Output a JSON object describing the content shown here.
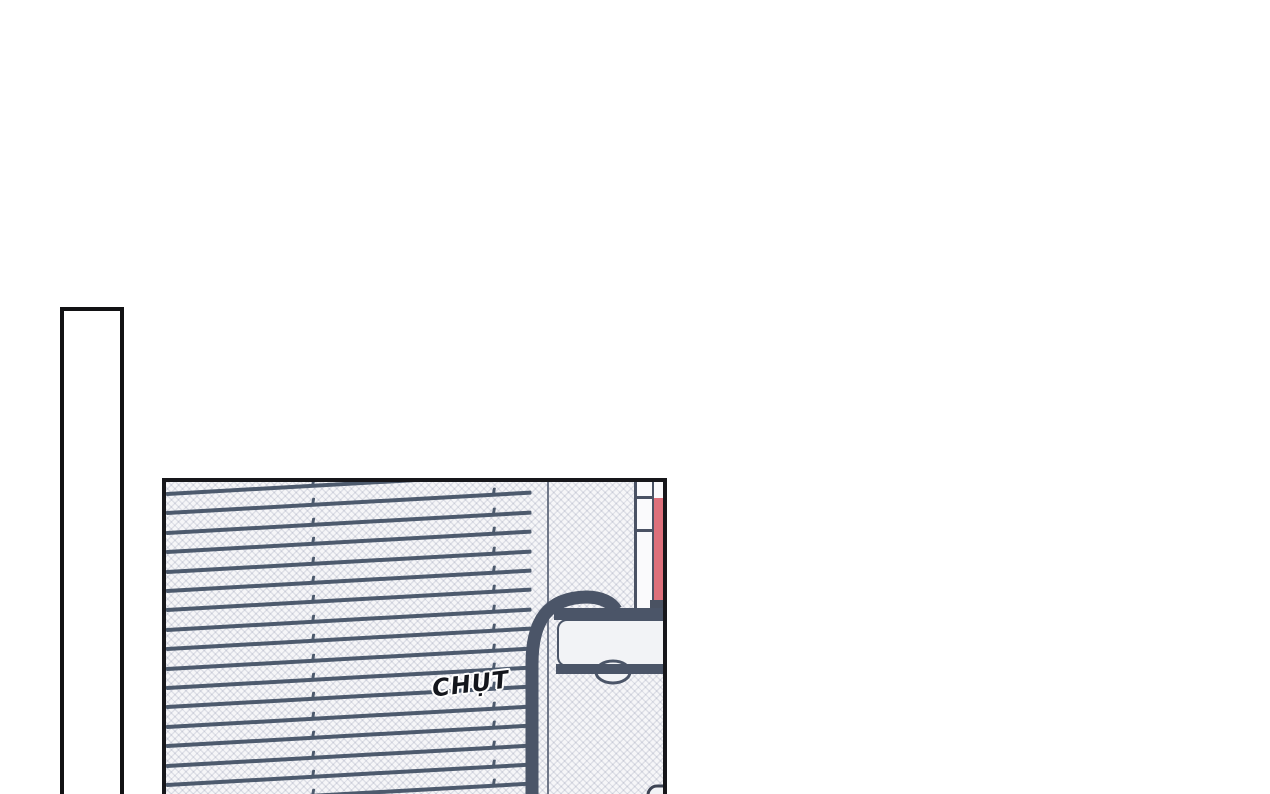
{
  "page": {
    "background": "#ffffff"
  },
  "sfx": {
    "text": "CHỤT",
    "color": "#14161c",
    "outline": "#ffffff"
  },
  "panels": {
    "left_sliver": {
      "description": "tall empty panel cut off at page bottom"
    },
    "main": {
      "description": "bedroom panel: window blinds, bookshelf with red book, bed headboard frame"
    }
  },
  "artwork": {
    "colors": {
      "panel_border": "#17171b",
      "slat": "#4d5a6d",
      "frame": "#4a5264",
      "pole": "#4b5568",
      "red_object": "#dd707b",
      "tone_base": "#f6f6f8",
      "ink": "#14161c"
    },
    "blinds": {
      "slat_count": 17,
      "first_slat_y": 10,
      "spacing": 19.4,
      "tilt_deg": -3.2,
      "tick_positions": [
        146,
        327
      ]
    }
  }
}
